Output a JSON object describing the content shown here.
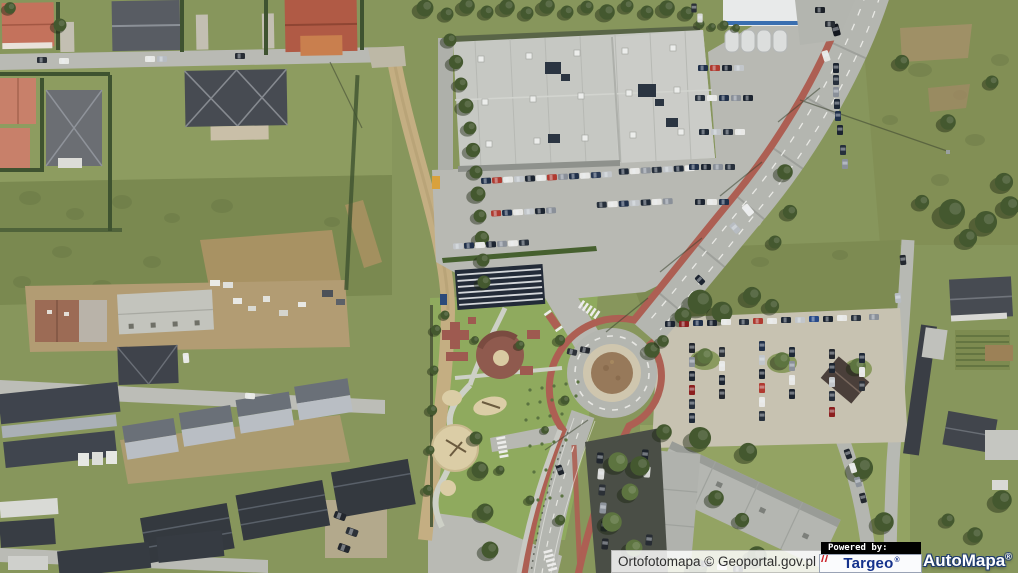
{
  "window": {
    "width": 1018,
    "height": 573
  },
  "map": {
    "kind": "aerial-orthophoto",
    "features": [
      "residential-area-northwest",
      "supermarket-building",
      "supermarket-parking-lot",
      "curved-main-road-with-cycle-path",
      "roundabout-with-brown-island",
      "playground-park",
      "gravel-parking-lot-east",
      "l-shaped-apartment-block",
      "terraced-garage-rows-southwest",
      "construction-site-west",
      "tree-lined-dirt-path",
      "allotment-gardens-east"
    ]
  },
  "attribution": {
    "text": "Ortofotomapa © Geoportal.gov.pl"
  },
  "branding": {
    "powered_by_label": "Powered by:",
    "targeo": {
      "name": "Targeo",
      "registered": "®"
    },
    "automapa": {
      "name": "AutoMapa",
      "registered": "®"
    }
  },
  "palette": {
    "grass": "#87965c",
    "scrub": "#7a8950",
    "trees": "#44582f",
    "road": "#b5b7b1",
    "dirt_path": "#c3ad80",
    "bike_path": "#ad5f53",
    "supermarket_roof": "#c6c8c3",
    "dark_roof": "#3e434b",
    "red_tile_roof": "#b75f4c",
    "sand": "#dbcda6",
    "roundabout_island": "#97795a",
    "targeo_blue": "#15328c",
    "targeo_red": "#cc2229",
    "automapa_outline": "#1e3a6e",
    "attribution_bg": "rgba(255,255,255,0.84)",
    "powered_by_bg": "#000000"
  }
}
